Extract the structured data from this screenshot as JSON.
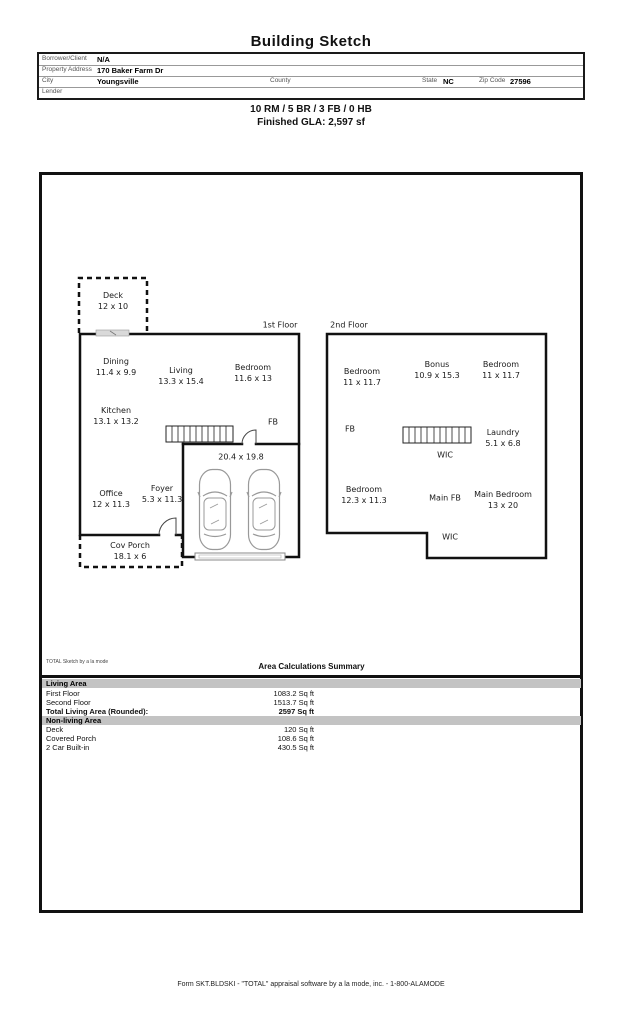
{
  "title": "Building Sketch",
  "form": {
    "rows": [
      {
        "label": "Borrower/Client",
        "value": "N/A"
      },
      {
        "label": "Property Address",
        "value": "170 Baker Farm Dr"
      },
      {
        "label": "City",
        "value": "Youngsville",
        "county_label": "County",
        "county_value": "",
        "state_label": "State",
        "state_value": "NC",
        "zip_label": "Zip Code",
        "zip_value": "27596"
      },
      {
        "label": "Lender",
        "value": ""
      }
    ]
  },
  "summary": {
    "line1": "10 RM / 5 BR / 3 FB / 0 HB",
    "line2": "Finished GLA: 2,597 sf"
  },
  "sketch": {
    "floor1_title": "1st Floor",
    "floor2_title": "2nd Floor",
    "rooms": {
      "deck": {
        "name": "Deck",
        "dims": "12 x 10"
      },
      "dining": {
        "name": "Dining",
        "dims": "11.4 x 9.9"
      },
      "living": {
        "name": "Living",
        "dims": "13.3 x 15.4"
      },
      "bedroom1": {
        "name": "Bedroom",
        "dims": "11.6 x 13"
      },
      "kitchen": {
        "name": "Kitchen",
        "dims": "13.1 x 13.2"
      },
      "fb1": {
        "name": "FB"
      },
      "garage": {
        "dims": "20.4 x 19.8"
      },
      "office": {
        "name": "Office",
        "dims": "12 x 11.3"
      },
      "foyer": {
        "name": "Foyer",
        "dims": "5.3 x 11.3"
      },
      "covporch": {
        "name": "Cov Porch",
        "dims": "18.1 x 6"
      },
      "bedroom2": {
        "name": "Bedroom",
        "dims": "11 x 11.7"
      },
      "bonus": {
        "name": "Bonus",
        "dims": "10.9 x 15.3"
      },
      "bedroom3": {
        "name": "Bedroom",
        "dims": "11 x 11.7"
      },
      "fb2": {
        "name": "FB"
      },
      "laundry": {
        "name": "Laundry",
        "dims": "5.1 x 6.8"
      },
      "wic1": {
        "name": "WIC"
      },
      "bedroom4": {
        "name": "Bedroom",
        "dims": "12.3 x 11.3"
      },
      "mainfb": {
        "name": "Main FB"
      },
      "mainbedroom": {
        "name": "Main Bedroom",
        "dims": "13 x 20"
      },
      "wic2": {
        "name": "WIC"
      }
    }
  },
  "area_summary": {
    "watermark": "TOTAL Sketch by a la mode",
    "title": "Area Calculations Summary",
    "living_header": "Living Area",
    "nonliving_header": "Non-living Area",
    "living_rows": [
      {
        "label": "First Floor",
        "value": "1083.2 Sq ft"
      },
      {
        "label": "Second Floor",
        "value": "1513.7 Sq ft"
      },
      {
        "label": "Total Living Area (Rounded):",
        "value": "2597 Sq ft"
      }
    ],
    "nonliving_rows": [
      {
        "label": "Deck",
        "value": "120 Sq ft"
      },
      {
        "label": "Covered Porch",
        "value": "108.6 Sq ft"
      },
      {
        "label": "2 Car Built-in",
        "value": "430.5 Sq ft"
      }
    ]
  },
  "footer": "Form SKT.BLDSKI - \"TOTAL\" appraisal software by a la mode, inc. - 1-800-ALAMODE"
}
